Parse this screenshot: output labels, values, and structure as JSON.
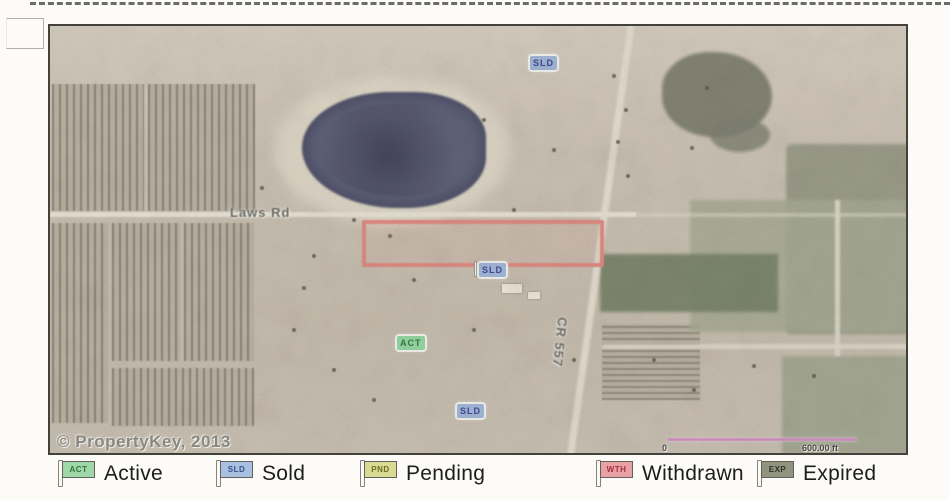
{
  "map": {
    "watermark": "© PropertyKey, 2013",
    "roads": [
      {
        "name": "Laws Rd"
      },
      {
        "name": "CR 557"
      }
    ],
    "scale_bar": {
      "start_label": "0",
      "end_label": "600.00 ft",
      "color": "#cf8abf"
    },
    "parcel_outline_color": "#e0837b",
    "lake_color": "#565872",
    "markers": [
      {
        "code": "SLD",
        "status": "sold",
        "bg": "#9db4da",
        "fg": "#343b8a"
      },
      {
        "code": "SLD",
        "status": "sold",
        "bg": "#9db4da",
        "fg": "#343b8a"
      },
      {
        "code": "ACT",
        "status": "active",
        "bg": "#8fd79f",
        "fg": "#2e6e3c"
      },
      {
        "code": "SLD",
        "status": "sold",
        "bg": "#9db4da",
        "fg": "#343b8a"
      }
    ]
  },
  "legend": {
    "items": [
      {
        "code": "ACT",
        "label": "Active",
        "bg": "#9ed7a8",
        "fg": "#35713f"
      },
      {
        "code": "SLD",
        "label": "Sold",
        "bg": "#a9c0e0",
        "fg": "#32508d"
      },
      {
        "code": "PND",
        "label": "Pending",
        "bg": "#d9da93",
        "fg": "#6f6d22"
      },
      {
        "code": "WTH",
        "label": "Withdrawn",
        "bg": "#eaa1a6",
        "fg": "#a23238"
      },
      {
        "code": "EXP",
        "label": "Expired",
        "bg": "#90947f",
        "fg": "#2f3226"
      }
    ]
  }
}
